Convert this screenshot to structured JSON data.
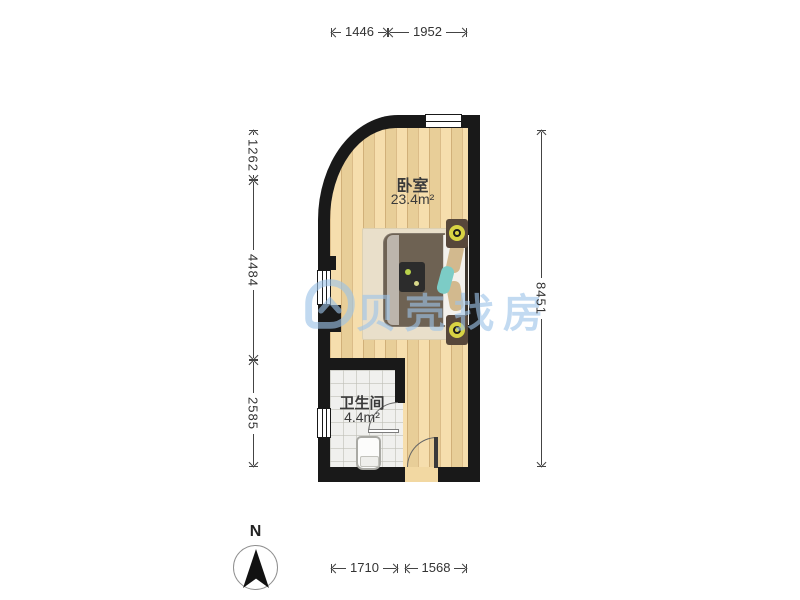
{
  "watermark": {
    "brand": "贝壳找房"
  },
  "north": {
    "label": "N"
  },
  "rooms": {
    "bedroom": {
      "name": "卧室",
      "area": "23.4m²"
    },
    "bathroom": {
      "name": "卫生间",
      "area": "4.4m²"
    }
  },
  "dimensions": {
    "top": [
      "1446",
      "1952"
    ],
    "left": [
      "1262",
      "4484",
      "2585"
    ],
    "right": [
      "8451"
    ],
    "bottom": [
      "1710",
      "1568"
    ]
  },
  "colors": {
    "wall": "#191919",
    "wood_floor": "#f4d9a0",
    "tile_floor": "#f0f0ee",
    "watermark_blue": "#9cc3e8",
    "lamp_accent": "#d8d343",
    "dimension_text": "#333333"
  }
}
